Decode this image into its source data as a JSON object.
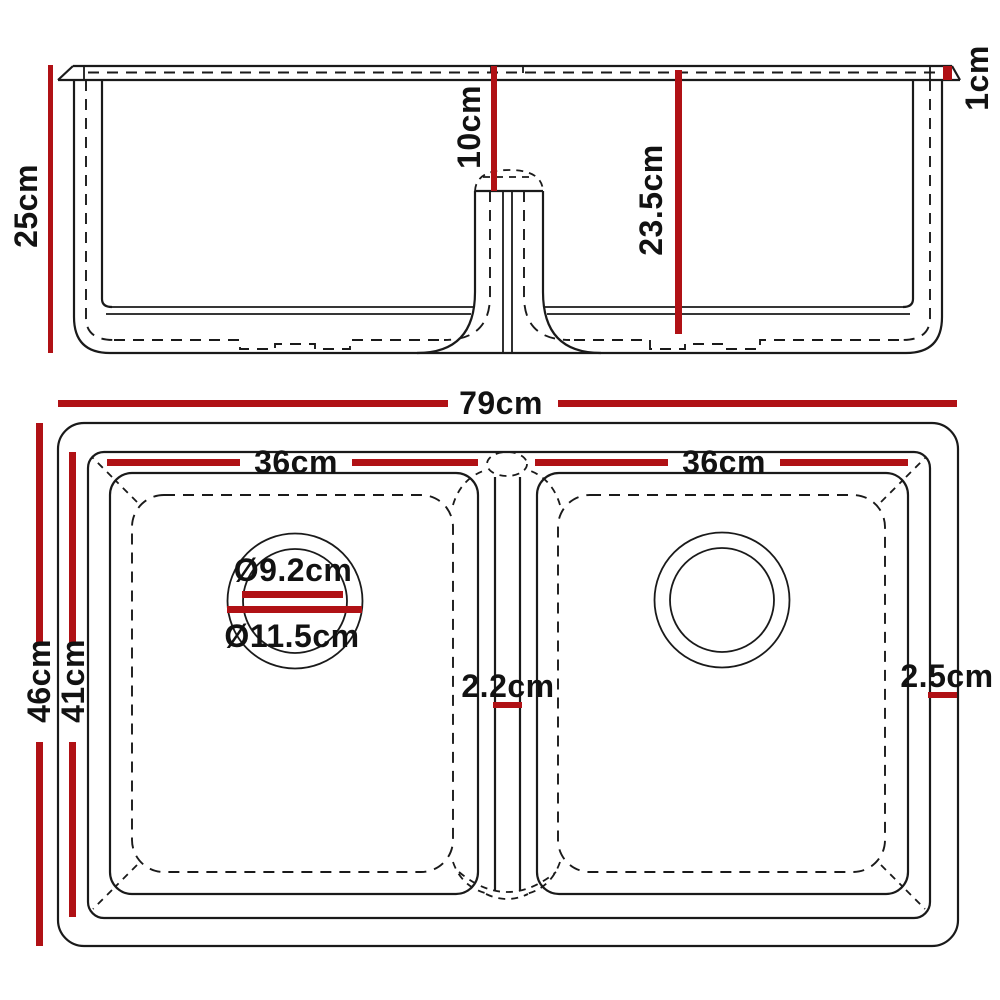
{
  "colors": {
    "dimension_red": "#b01115",
    "line": "#1a1a1a",
    "background": "#ffffff"
  },
  "front_view": {
    "height_total": "25cm",
    "divider_depth": "10cm",
    "bowl_depth": "23.5cm",
    "rim_edge": "1cm"
  },
  "top_view": {
    "width_total": "79cm",
    "bowl_left_width": "36cm",
    "bowl_right_width": "36cm",
    "depth_total": "46cm",
    "depth_inner": "41cm",
    "drain_inner": "Ø9.2cm",
    "drain_outer": "Ø11.5cm",
    "divider_gap": "2.2cm",
    "edge_right": "2.5cm"
  }
}
